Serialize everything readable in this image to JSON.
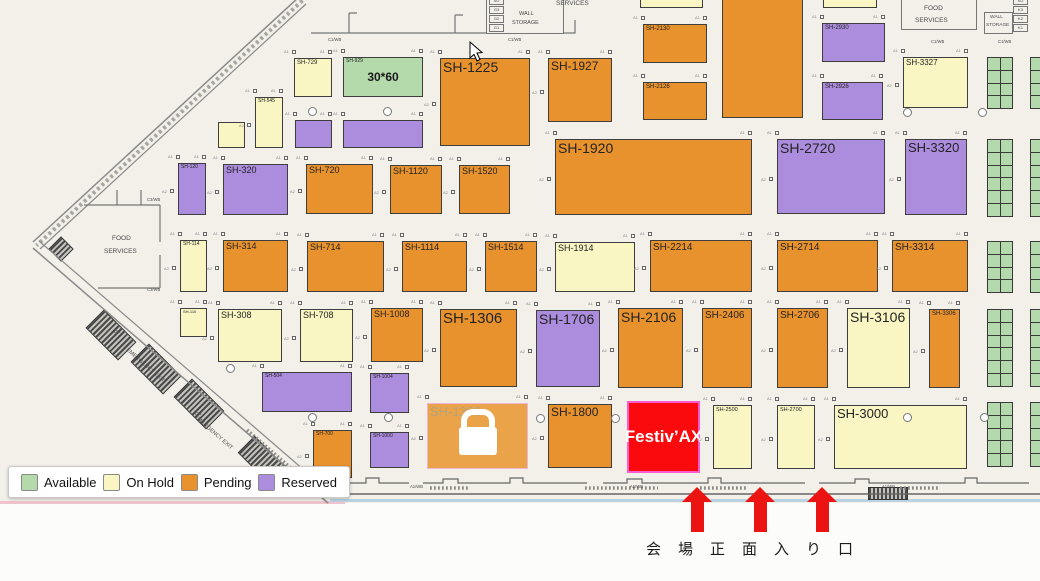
{
  "map": {
    "status_colors": {
      "available": "#b4d9ab",
      "onhold": "#f9f6c4",
      "pending": "#e8922e",
      "reserved": "#ac8cdd",
      "locked": "#eaa349",
      "sold": "#fb0a0d",
      "sold_border": "#ff5ad0",
      "booth_border": "#3e3e3e"
    },
    "booths": [
      {
        "id": "SH-729",
        "x": 294,
        "y": 58,
        "w": 38,
        "h": 39,
        "s": "onhold",
        "fs": 6
      },
      {
        "id": "SH-929",
        "x": 343,
        "y": 57,
        "w": 80,
        "h": 40,
        "s": "available",
        "fs": 5,
        "center": "30*60"
      },
      {
        "id": "SH-1225",
        "x": 440,
        "y": 58,
        "w": 90,
        "h": 88,
        "s": "pending",
        "fs": 14
      },
      {
        "id": "SH-1927",
        "x": 548,
        "y": 58,
        "w": 64,
        "h": 64,
        "s": "pending",
        "fs": 12
      },
      {
        "id": "SH-2130",
        "x": 643,
        "y": 24,
        "w": 64,
        "h": 39,
        "s": "pending",
        "fs": 6
      },
      {
        "id": "SH-2126",
        "x": 643,
        "y": 82,
        "w": 64,
        "h": 38,
        "s": "pending",
        "fs": 6
      },
      {
        "id": "",
        "x": 722,
        "y": -6,
        "w": 81,
        "h": 124,
        "s": "pending",
        "fs": 0
      },
      {
        "id": "SH-2930",
        "x": 822,
        "y": 23,
        "w": 63,
        "h": 39,
        "s": "reserved",
        "fs": 6
      },
      {
        "id": "SH-2926",
        "x": 822,
        "y": 82,
        "w": 61,
        "h": 38,
        "s": "reserved",
        "fs": 6
      },
      {
        "id": "SH-3327",
        "x": 903,
        "y": 57,
        "w": 65,
        "h": 51,
        "s": "onhold",
        "fs": 8
      },
      {
        "id": "",
        "x": 640,
        "y": -4,
        "w": 63,
        "h": 12,
        "s": "onhold",
        "fs": 0
      },
      {
        "id": "",
        "x": 823,
        "y": -4,
        "w": 54,
        "h": 12,
        "s": "onhold",
        "fs": 0
      },
      {
        "id": "SH-545",
        "x": 255,
        "y": 97,
        "w": 28,
        "h": 51,
        "s": "onhold",
        "fs": 5
      },
      {
        "id": "",
        "x": 218,
        "y": 122,
        "w": 27,
        "h": 26,
        "s": "onhold",
        "fs": 0
      },
      {
        "id": "",
        "x": 295,
        "y": 120,
        "w": 37,
        "h": 28,
        "s": "reserved",
        "fs": 0
      },
      {
        "id": "",
        "x": 343,
        "y": 120,
        "w": 80,
        "h": 28,
        "s": "reserved",
        "fs": 0
      },
      {
        "id": "SH-120",
        "x": 178,
        "y": 163,
        "w": 28,
        "h": 52,
        "s": "reserved",
        "fs": 5
      },
      {
        "id": "SH-320",
        "x": 223,
        "y": 164,
        "w": 65,
        "h": 51,
        "s": "reserved",
        "fs": 9
      },
      {
        "id": "SH-720",
        "x": 306,
        "y": 164,
        "w": 67,
        "h": 50,
        "s": "pending",
        "fs": 9
      },
      {
        "id": "SH-1120",
        "x": 390,
        "y": 165,
        "w": 52,
        "h": 49,
        "s": "pending",
        "fs": 9
      },
      {
        "id": "SH-1520",
        "x": 459,
        "y": 165,
        "w": 51,
        "h": 49,
        "s": "pending",
        "fs": 9
      },
      {
        "id": "SH-1920",
        "x": 555,
        "y": 139,
        "w": 197,
        "h": 76,
        "s": "pending",
        "fs": 14
      },
      {
        "id": "SH-2720",
        "x": 777,
        "y": 139,
        "w": 108,
        "h": 75,
        "s": "reserved",
        "fs": 14
      },
      {
        "id": "SH-3320",
        "x": 905,
        "y": 139,
        "w": 62,
        "h": 76,
        "s": "reserved",
        "fs": 13
      },
      {
        "id": "SH-114",
        "x": 180,
        "y": 240,
        "w": 27,
        "h": 52,
        "s": "onhold",
        "fs": 5
      },
      {
        "id": "SH-314",
        "x": 223,
        "y": 240,
        "w": 65,
        "h": 52,
        "s": "pending",
        "fs": 9
      },
      {
        "id": "SH-714",
        "x": 307,
        "y": 241,
        "w": 77,
        "h": 51,
        "s": "pending",
        "fs": 9
      },
      {
        "id": "SH-1114",
        "x": 402,
        "y": 241,
        "w": 65,
        "h": 51,
        "s": "pending",
        "fs": 9
      },
      {
        "id": "SH-1514",
        "x": 485,
        "y": 241,
        "w": 52,
        "h": 51,
        "s": "pending",
        "fs": 9
      },
      {
        "id": "SH-1914",
        "x": 555,
        "y": 242,
        "w": 80,
        "h": 50,
        "s": "onhold",
        "fs": 9
      },
      {
        "id": "SH-2214",
        "x": 650,
        "y": 240,
        "w": 102,
        "h": 52,
        "s": "pending",
        "fs": 10
      },
      {
        "id": "SH-2714",
        "x": 777,
        "y": 240,
        "w": 101,
        "h": 52,
        "s": "pending",
        "fs": 10
      },
      {
        "id": "SH-3314",
        "x": 892,
        "y": 240,
        "w": 76,
        "h": 52,
        "s": "pending",
        "fs": 10
      },
      {
        "id": "SH-110",
        "x": 180,
        "y": 308,
        "w": 27,
        "h": 29,
        "s": "onhold",
        "fs": 4
      },
      {
        "id": "SH-308",
        "x": 218,
        "y": 309,
        "w": 64,
        "h": 53,
        "s": "onhold",
        "fs": 9
      },
      {
        "id": "SH-708",
        "x": 300,
        "y": 309,
        "w": 53,
        "h": 53,
        "s": "onhold",
        "fs": 9
      },
      {
        "id": "SH-1008",
        "x": 371,
        "y": 308,
        "w": 52,
        "h": 54,
        "s": "pending",
        "fs": 9
      },
      {
        "id": "SH-1306",
        "x": 440,
        "y": 309,
        "w": 77,
        "h": 78,
        "s": "pending",
        "fs": 15
      },
      {
        "id": "SH-1706",
        "x": 536,
        "y": 310,
        "w": 64,
        "h": 77,
        "s": "reserved",
        "fs": 14
      },
      {
        "id": "SH-2106",
        "x": 618,
        "y": 308,
        "w": 65,
        "h": 80,
        "s": "pending",
        "fs": 14
      },
      {
        "id": "SH-2406",
        "x": 702,
        "y": 308,
        "w": 50,
        "h": 80,
        "s": "pending",
        "fs": 10
      },
      {
        "id": "SH-2706",
        "x": 777,
        "y": 308,
        "w": 51,
        "h": 80,
        "s": "pending",
        "fs": 10
      },
      {
        "id": "SH-3106",
        "x": 847,
        "y": 308,
        "w": 63,
        "h": 80,
        "s": "onhold",
        "fs": 14
      },
      {
        "id": "SH-3306",
        "x": 929,
        "y": 309,
        "w": 31,
        "h": 79,
        "s": "pending",
        "fs": 6
      },
      {
        "id": "SH-504",
        "x": 262,
        "y": 372,
        "w": 90,
        "h": 40,
        "s": "reserved",
        "fs": 5
      },
      {
        "id": "SH-1004",
        "x": 370,
        "y": 373,
        "w": 39,
        "h": 40,
        "s": "reserved",
        "fs": 5
      },
      {
        "id": "SH-700",
        "x": 313,
        "y": 430,
        "w": 39,
        "h": 48,
        "s": "pending",
        "fs": 5
      },
      {
        "id": "SH-1000",
        "x": 370,
        "y": 432,
        "w": 39,
        "h": 36,
        "s": "reserved",
        "fs": 5
      },
      {
        "id": "SH-1300",
        "x": 427,
        "y": 403,
        "w": 101,
        "h": 66,
        "s": "locked",
        "fs": 13,
        "lock": true
      },
      {
        "id": "SH-1800",
        "x": 548,
        "y": 404,
        "w": 64,
        "h": 64,
        "s": "pending",
        "fs": 12
      },
      {
        "id": "Festiv’AX",
        "x": 627,
        "y": 401,
        "w": 73,
        "h": 72,
        "s": "sold",
        "fs": 17
      },
      {
        "id": "SH-2500",
        "x": 713,
        "y": 405,
        "w": 39,
        "h": 64,
        "s": "onhold",
        "fs": 5.5
      },
      {
        "id": "SH-2700",
        "x": 777,
        "y": 405,
        "w": 38,
        "h": 64,
        "s": "onhold",
        "fs": 5.5
      },
      {
        "id": "SH-3000",
        "x": 834,
        "y": 405,
        "w": 133,
        "h": 64,
        "s": "onhold",
        "fs": 13
      }
    ],
    "green_grids": [
      {
        "x": 987,
        "y": 57,
        "rows": 4
      },
      {
        "x": 987,
        "y": 139,
        "rows": 6
      },
      {
        "x": 987,
        "y": 241,
        "rows": 4
      },
      {
        "x": 987,
        "y": 309,
        "rows": 6
      },
      {
        "x": 987,
        "y": 402,
        "rows": 5
      },
      {
        "x": 1030,
        "y": 57,
        "rows": 4
      },
      {
        "x": 1030,
        "y": 139,
        "rows": 6
      },
      {
        "x": 1030,
        "y": 241,
        "rows": 4
      },
      {
        "x": 1030,
        "y": 309,
        "rows": 6
      },
      {
        "x": 1030,
        "y": 402,
        "rows": 5
      }
    ],
    "rooms": [
      {
        "x": 486,
        "y": -5,
        "w": 78,
        "h": 39
      },
      {
        "x": 901,
        "y": -6,
        "w": 76,
        "h": 36
      },
      {
        "x": 984,
        "y": 12,
        "w": 29,
        "h": 22
      }
    ],
    "utility_boxes": [
      {
        "x": 489,
        "y": 24,
        "w": 15,
        "h": 8,
        "label": "G1"
      },
      {
        "x": 489,
        "y": 15,
        "w": 15,
        "h": 8,
        "label": "G2"
      },
      {
        "x": 489,
        "y": 6,
        "w": 15,
        "h": 8,
        "label": "G3"
      },
      {
        "x": 489,
        "y": -3,
        "w": 15,
        "h": 8,
        "label": "SO"
      },
      {
        "x": 1013,
        "y": 24,
        "w": 15,
        "h": 8,
        "label": "K1"
      },
      {
        "x": 1013,
        "y": 15,
        "w": 15,
        "h": 8,
        "label": "K2"
      },
      {
        "x": 1013,
        "y": 6,
        "w": 15,
        "h": 8,
        "label": "K3"
      },
      {
        "x": 1013,
        "y": -3,
        "w": 15,
        "h": 8,
        "label": "SO"
      }
    ],
    "area_labels": [
      {
        "t": "SERVICES",
        "x": 556,
        "y": 1,
        "fs": 6.5
      },
      {
        "t": "WALL",
        "x": 519,
        "y": 12,
        "fs": 5.5
      },
      {
        "t": "STORAGE",
        "x": 512,
        "y": 21,
        "fs": 5.5
      },
      {
        "t": "FOOD",
        "x": 924,
        "y": 6,
        "fs": 6.5
      },
      {
        "t": "SERVICES",
        "x": 915,
        "y": 18,
        "fs": 6.5
      },
      {
        "t": "WALL",
        "x": 990,
        "y": 16,
        "fs": 4.8
      },
      {
        "t": "STORAGE",
        "x": 986,
        "y": 24,
        "fs": 4.8
      },
      {
        "t": "FOOD",
        "x": 112,
        "y": 236,
        "fs": 6.5
      },
      {
        "t": "SERVICES",
        "x": 104,
        "y": 249,
        "fs": 6.5
      },
      {
        "t": "C1/WB",
        "x": 328,
        "y": 38,
        "fs": 4.2
      },
      {
        "t": "C1/WB",
        "x": 508,
        "y": 38,
        "fs": 4.2
      },
      {
        "t": "C1/WB",
        "x": 931,
        "y": 40,
        "fs": 4.2
      },
      {
        "t": "C1/WB",
        "x": 998,
        "y": 40,
        "fs": 4.2
      },
      {
        "t": "C3/WB",
        "x": 147,
        "y": 198,
        "fs": 4.2
      },
      {
        "t": "C3/WB",
        "x": 147,
        "y": 288,
        "fs": 4.2
      },
      {
        "t": "A1/WB",
        "x": 410,
        "y": 485,
        "fs": 4.2
      },
      {
        "t": "A1/WB",
        "x": 630,
        "y": 485,
        "fs": 4.2
      },
      {
        "t": "A1/WB",
        "x": 882,
        "y": 485,
        "fs": 4.2
      },
      {
        "t": "EMERGENCY EXIT",
        "x": 128,
        "y": 348,
        "fs": 5.5,
        "rot": 41
      },
      {
        "t": "EMERGENCY EXIT",
        "x": 196,
        "y": 415,
        "fs": 5.5,
        "rot": 41
      },
      {
        "t": "DN",
        "x": 114,
        "y": 330,
        "fs": 4.5
      },
      {
        "t": "DN",
        "x": 195,
        "y": 412,
        "fs": 4.5
      }
    ],
    "circles": [
      [
        313,
        112
      ],
      [
        388,
        112
      ],
      [
        908,
        113
      ],
      [
        983,
        113
      ],
      [
        231,
        369
      ],
      [
        313,
        418
      ],
      [
        389,
        418
      ],
      [
        541,
        419
      ],
      [
        616,
        419
      ],
      [
        908,
        418
      ],
      [
        985,
        418
      ]
    ]
  },
  "legend": {
    "items": [
      {
        "label": "Available",
        "status": "available"
      },
      {
        "label": "On Hold",
        "status": "onhold"
      },
      {
        "label": "Pending",
        "status": "pending"
      },
      {
        "label": "Reserved",
        "status": "reserved"
      }
    ]
  },
  "entrance": {
    "label": "会場正面入り口",
    "arrow_xs": [
      697,
      760,
      822
    ],
    "arrow_color": "#ec1313"
  }
}
